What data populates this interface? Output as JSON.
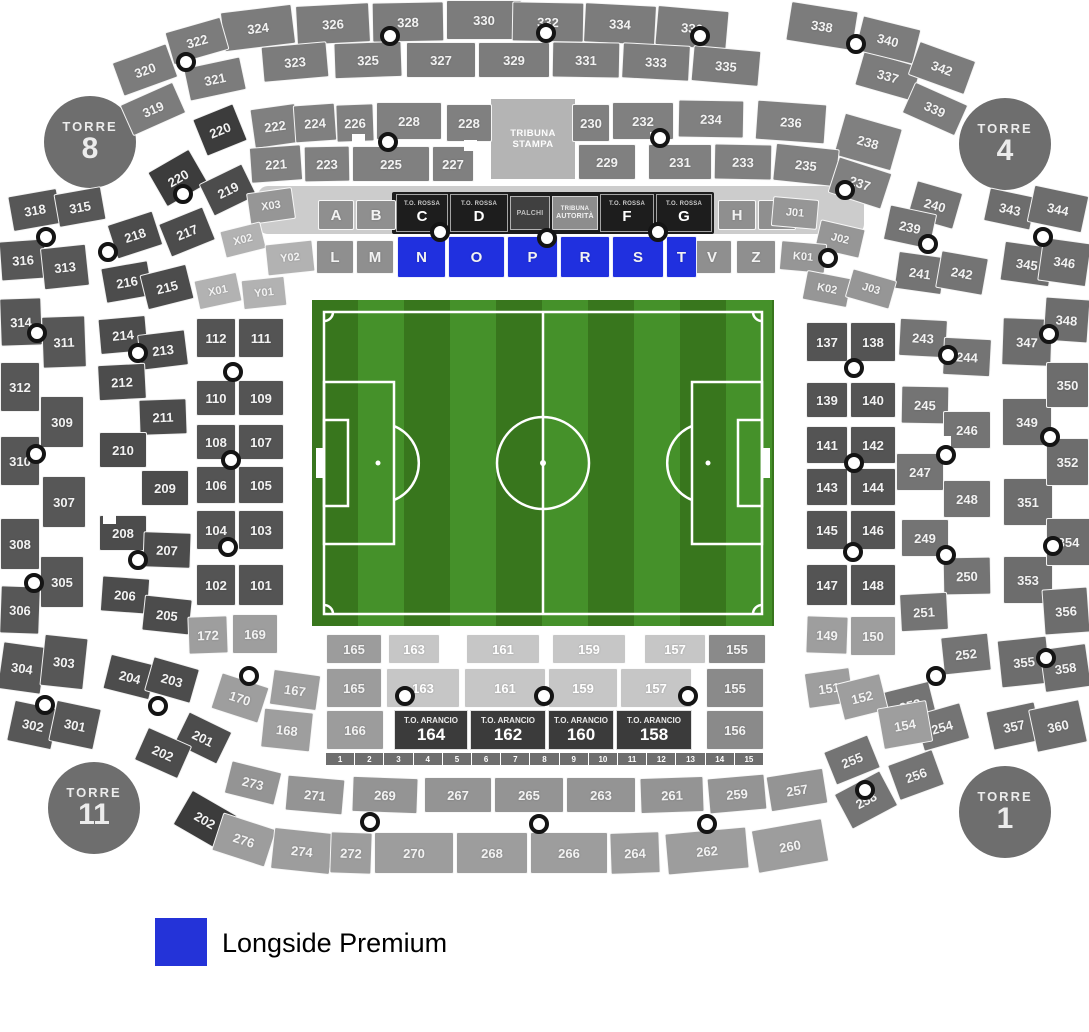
{
  "legend": {
    "label": "Longside Premium",
    "swatch_color": "#2433d8"
  },
  "premium_color": "#2030df",
  "towers": [
    {
      "title": "TORRE",
      "number": "8"
    },
    {
      "title": "TORRE",
      "number": "4"
    },
    {
      "title": "TORRE",
      "number": "11"
    },
    {
      "title": "TORRE",
      "number": "1"
    }
  ],
  "tribuna_stampa": {
    "line1": "TRIBUNA",
    "line2": "STAMPA"
  },
  "vip_strip": [
    {
      "top": "T.O. ROSSA",
      "main": "C"
    },
    {
      "top": "T.O. ROSSA",
      "main": "D"
    },
    {
      "top": "",
      "main": "PALCHI"
    },
    {
      "top": "TRIBUNA",
      "main": "AUTORITÀ"
    },
    {
      "top": "T.O. ROSSA",
      "main": "F"
    },
    {
      "top": "T.O. ROSSA",
      "main": "G"
    }
  ],
  "arancio": [
    {
      "title": "T.O. ARANCIO",
      "number": "164"
    },
    {
      "title": "T.O. ARANCIO",
      "number": "162"
    },
    {
      "title": "T.O. ARANCIO",
      "number": "160"
    },
    {
      "title": "T.O. ARANCIO",
      "number": "158"
    }
  ],
  "gate_numbers": [
    "1",
    "2",
    "3",
    "4",
    "5",
    "6",
    "7",
    "8",
    "9",
    "10",
    "11",
    "12",
    "13",
    "14",
    "15"
  ],
  "sections": {
    "t3_top1": [
      "324",
      "326",
      "328",
      "330",
      "332",
      "334",
      "336",
      "338"
    ],
    "t3_top2": [
      "323",
      "325",
      "327",
      "329",
      "331",
      "333",
      "335",
      "337"
    ],
    "t3_topleft": [
      "322",
      "320",
      "321",
      "319"
    ],
    "t3_topright": [
      "340",
      "342",
      "339"
    ],
    "t3_left_outer": [
      "318",
      "316",
      "314",
      "312",
      "310",
      "308",
      "306",
      "304",
      "302"
    ],
    "t3_left_inner": [
      "315",
      "313",
      "311",
      "309",
      "307",
      "305",
      "303",
      "301"
    ],
    "t3_right_inner": [
      "343",
      "345",
      "347",
      "349",
      "351",
      "353",
      "355",
      "357"
    ],
    "t3_right_outer": [
      "344",
      "346",
      "348",
      "350",
      "352",
      "354",
      "356",
      "358",
      "360"
    ],
    "t2_top_left": [
      "220",
      "222",
      "224",
      "226",
      "228",
      "228"
    ],
    "t2_top_right": [
      "230",
      "232",
      "234",
      "236",
      "238"
    ],
    "t2_row2_left": [
      "221",
      "223",
      "225",
      "227"
    ],
    "t2_row2_right": [
      "229",
      "231",
      "233",
      "235",
      "237"
    ],
    "t2_left": [
      "220",
      "219",
      "218",
      "217",
      "216",
      "215",
      "214",
      "213",
      "212",
      "211",
      "210",
      "209",
      "208",
      "207",
      "206",
      "205",
      "204",
      "203",
      "201",
      "202",
      "202"
    ],
    "t2_right": [
      "240",
      "239",
      "241",
      "242",
      "243",
      "244",
      "245",
      "246",
      "247",
      "248",
      "249",
      "250",
      "251",
      "252",
      "253",
      "254",
      "255",
      "256",
      "258"
    ],
    "t2_bottom_row1": [
      "273",
      "271",
      "269",
      "267",
      "265",
      "263",
      "261",
      "259",
      "257"
    ],
    "t2_bottom_row2": [
      "276",
      "274",
      "272",
      "270",
      "268",
      "266",
      "264",
      "262",
      "260"
    ],
    "letters_row1_left": [
      "A",
      "B"
    ],
    "letters_row1_right": [
      "H",
      "I"
    ],
    "letters_row2_left": [
      "L",
      "M"
    ],
    "letters_row2_right": [
      "V",
      "Z"
    ],
    "premium": [
      "N",
      "O",
      "P",
      "R",
      "S",
      "T"
    ],
    "codes_left": [
      "X03",
      "X02",
      "Y02",
      "X01",
      "Y01"
    ],
    "codes_right": [
      "J01",
      "J02",
      "K01",
      "K02",
      "J03"
    ],
    "t1_left": [
      "112",
      "111",
      "110",
      "109",
      "108",
      "107",
      "106",
      "105",
      "104",
      "103",
      "102",
      "101"
    ],
    "t1_left_lower": [
      "172",
      "169",
      "170",
      "167",
      "168"
    ],
    "t1_right": [
      "137",
      "138",
      "139",
      "140",
      "141",
      "142",
      "143",
      "144",
      "145",
      "146",
      "147",
      "148"
    ],
    "t1_right_lower": [
      "149",
      "150",
      "151",
      "152",
      "154"
    ],
    "t1_bottom_row0": [
      "165",
      "163",
      "161",
      "159",
      "157",
      "155"
    ],
    "t1_bottom_row1": [
      "165",
      "163",
      "161",
      "159",
      "157",
      "155"
    ],
    "t1_bottom_row2_ends": [
      "166",
      "156"
    ]
  }
}
